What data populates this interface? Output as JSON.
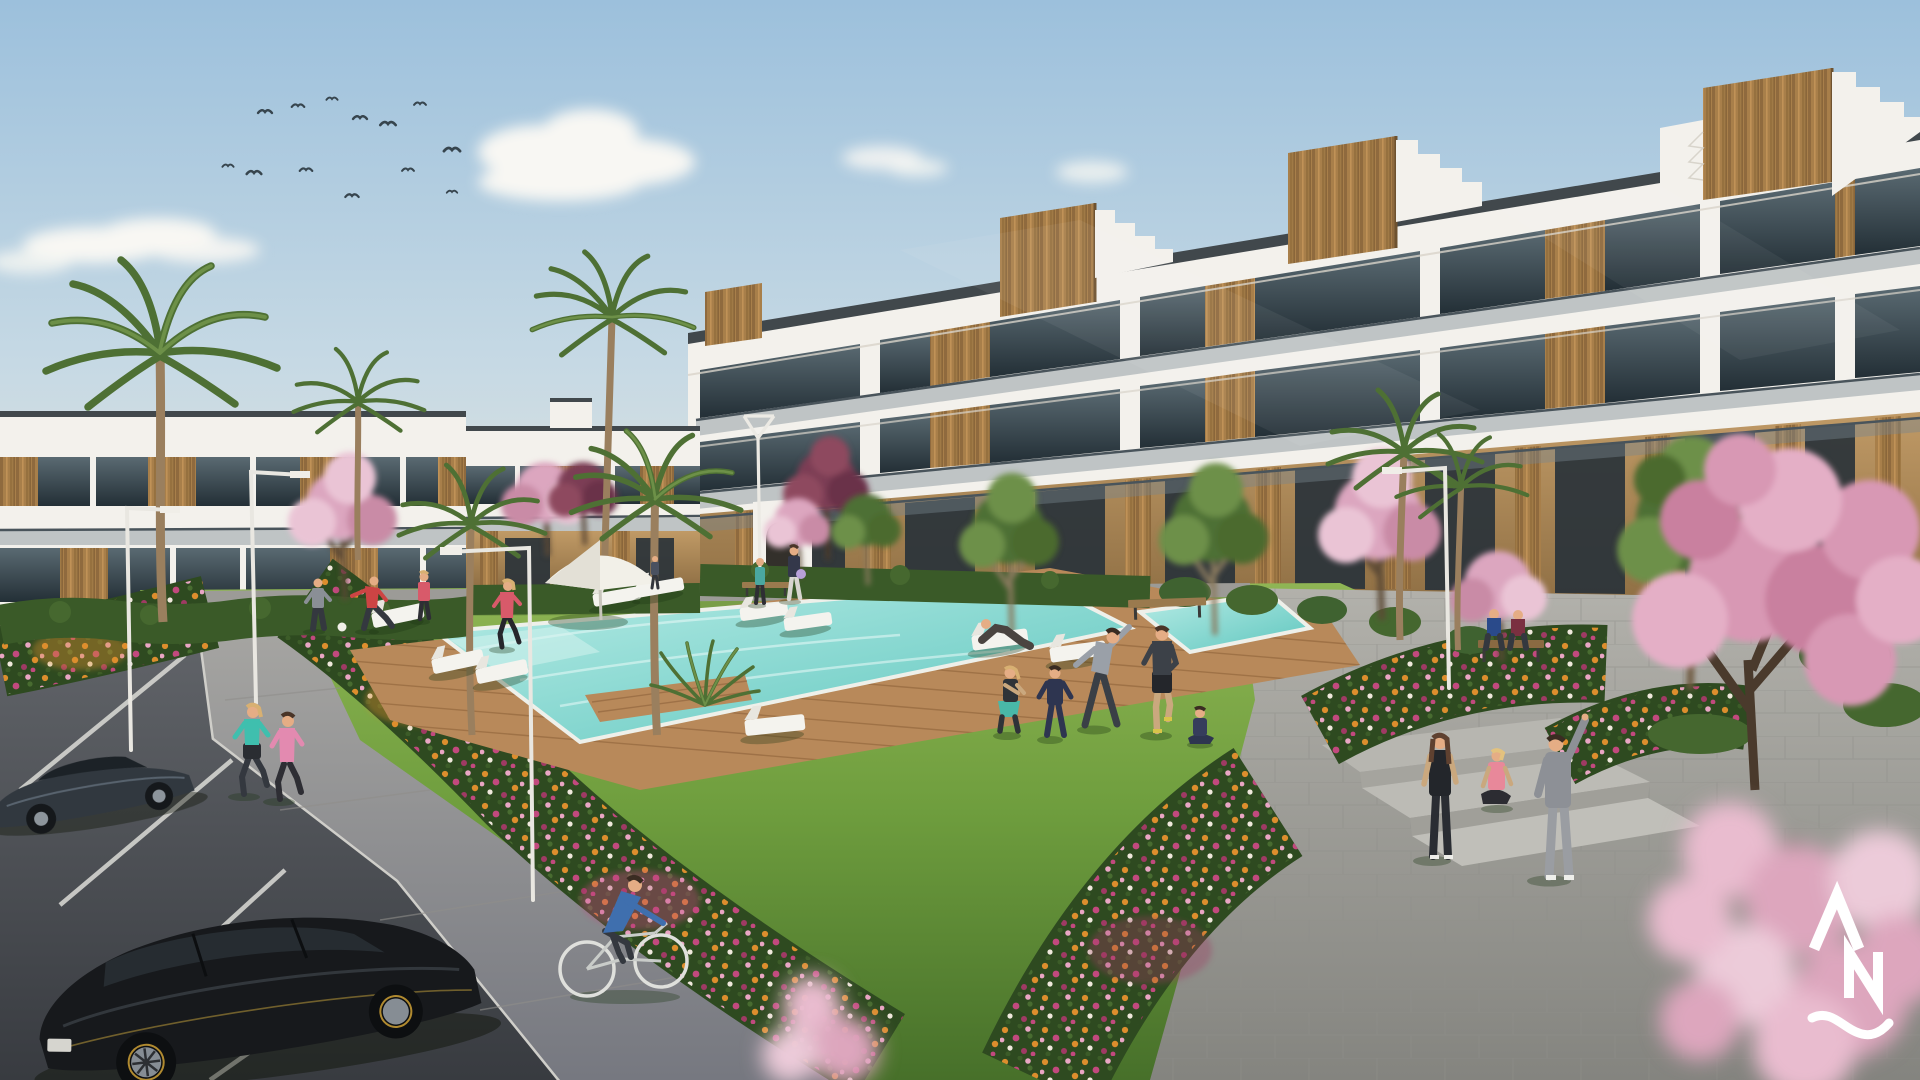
{
  "scene": {
    "type": "architectural-exterior-render",
    "title": "New-build residential complex render - white apartment blocks with wood accents around a landscaped courtyard with swimming pool, flower gardens, parking and residents exercising",
    "time_of_day": "daytime",
    "sky": "pale blue with small flock of birds and soft clouds",
    "watermark_position": "bottom-right"
  },
  "palette": {
    "sky_top": "#9cc0dc",
    "sky_mid": "#c6d9e4",
    "sky_horizon": "#eae7dd",
    "cloud": "#f8f7f3",
    "building_white": "#f3f1ec",
    "building_shade": "#dcd8cf",
    "roof_edge": "#41484c",
    "glass_top": "#5a6a72",
    "glass_bottom": "#232f36",
    "wood": "#a87f4a",
    "wood_dark": "#7d5a36",
    "tan_wall": "#c09a66",
    "hedge": "#3a5a28",
    "hedge_light": "#4c7033",
    "lawn_light": "#8fb554",
    "lawn": "#6f9e3e",
    "lawn_dark": "#47702a",
    "deck": "#b8895a",
    "pool_light": "#b8ece6",
    "pool": "#5ec6be",
    "path": "#a3a29e",
    "plaza": "#abaaa4",
    "asphalt": "#5b5e61",
    "line_white": "#e8e8e3",
    "flower_orange": "#dd8e2d",
    "flower_magenta": "#c2497e",
    "flower_pink": "#e9a6c4",
    "flower_crimson": "#a03a64",
    "blossom": "#dca6bf",
    "blossom_light": "#eac4d5",
    "foliage": "#4e7034",
    "foliage_light": "#6d9048",
    "trunk": "#8d7354",
    "skin": "#e5ad85",
    "logo": "#ffffff"
  },
  "watermark": {
    "label": "developer-logo",
    "glyphs": [
      "caret",
      "N",
      "wave"
    ],
    "color": "#ffffff"
  },
  "counts": {
    "birds": 13,
    "clouds": 5,
    "palm_trees": 7,
    "blossom_trees": 6,
    "green_trees": 4,
    "street_lamps": 5,
    "sun_loungers": 10,
    "parasols": 1,
    "benches": 3,
    "cars": 2,
    "bicycles": 1,
    "people": 21
  }
}
